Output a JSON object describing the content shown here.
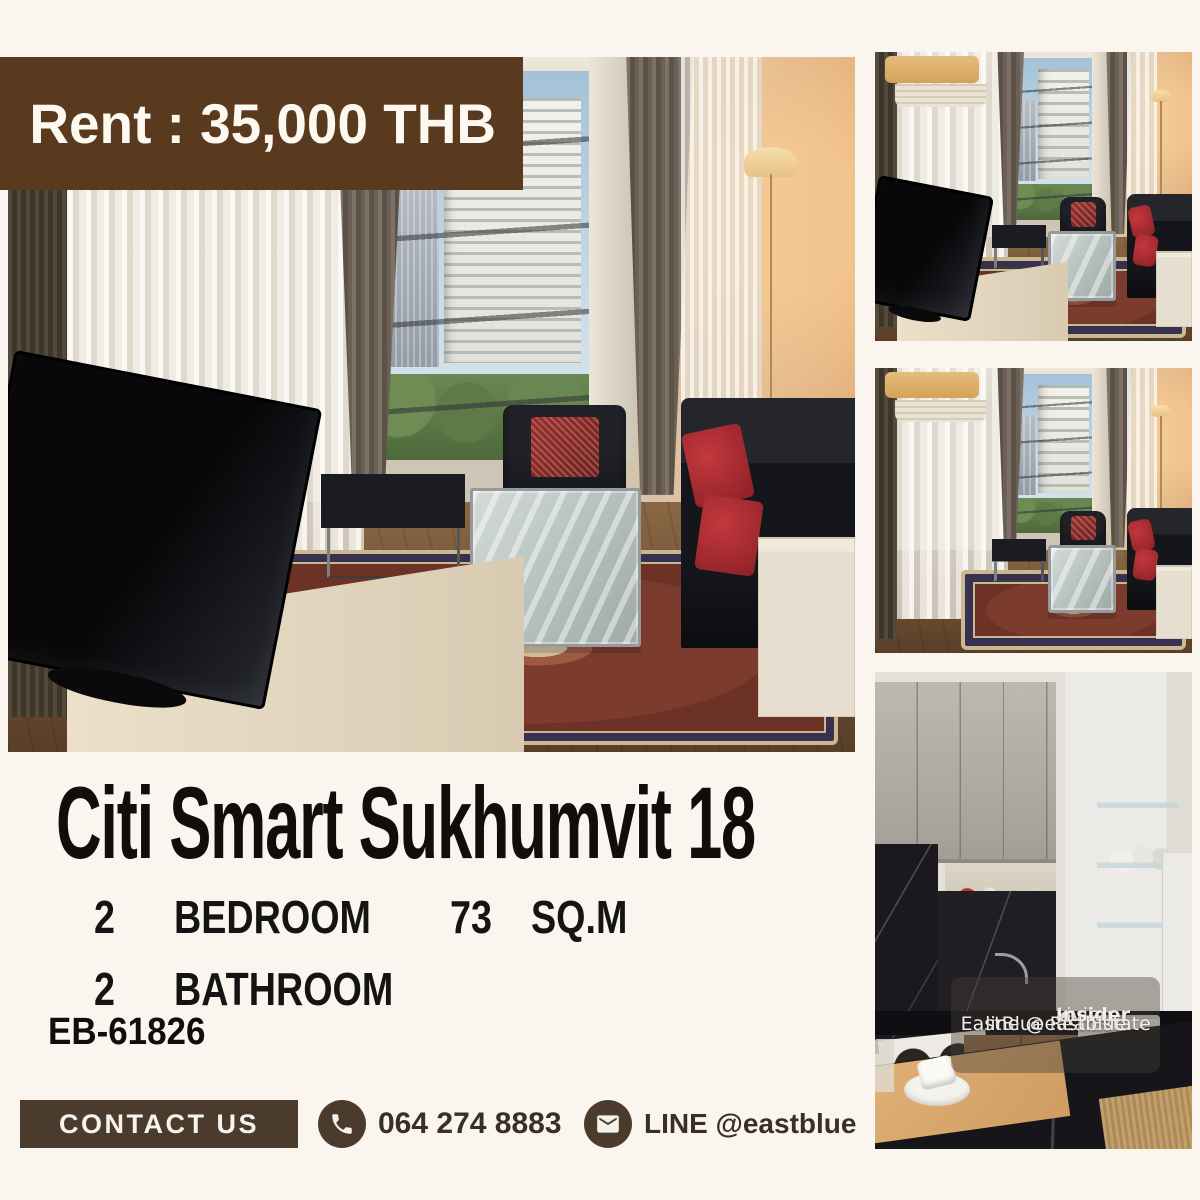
{
  "colors": {
    "background": "#faf5ee",
    "banner_bg": "#5a3a1e",
    "banner_text": "#fdf9f1",
    "contact_bg": "#4a3b2c",
    "contact_text": "#3a2f24",
    "heading_text": "#0f0e0c"
  },
  "banner": {
    "label": "Rent : 35,000 THB"
  },
  "listing": {
    "title": "Citi Smart Sukhumvit 18",
    "specs": [
      {
        "qty": "2",
        "label": "BEDROOM",
        "qty2": "73",
        "label2": "SQ.M"
      },
      {
        "qty": "2",
        "label": "BATHROOM",
        "qty2": "",
        "label2": ""
      }
    ],
    "code": "EB-61826"
  },
  "contact": {
    "button_label": "CONTACT US",
    "phone": "064 274 8883",
    "line": "LINE @eastblue"
  },
  "watermark": {
    "brand_light": "Living",
    "brand_bold": "Insider",
    "brand_tld": "com",
    "line1": "EastBlue RealEstate",
    "line2": "line @eastblue"
  },
  "photos": {
    "main": {
      "building_sign": "Park Plaza",
      "desc": "Living room with corner window city view, black leather sofas, glass coffee table, oriental rug and TV on sideboard"
    },
    "top_right": {
      "desc": "Living room viewed past the TV toward the corner window"
    },
    "middle_right": {
      "desc": "Living room with air conditioner, sheer curtains and corner window"
    },
    "bottom_right": {
      "desc": "Kitchen with grey cabinets, black marble counters, sink, hob and washing machine"
    }
  }
}
